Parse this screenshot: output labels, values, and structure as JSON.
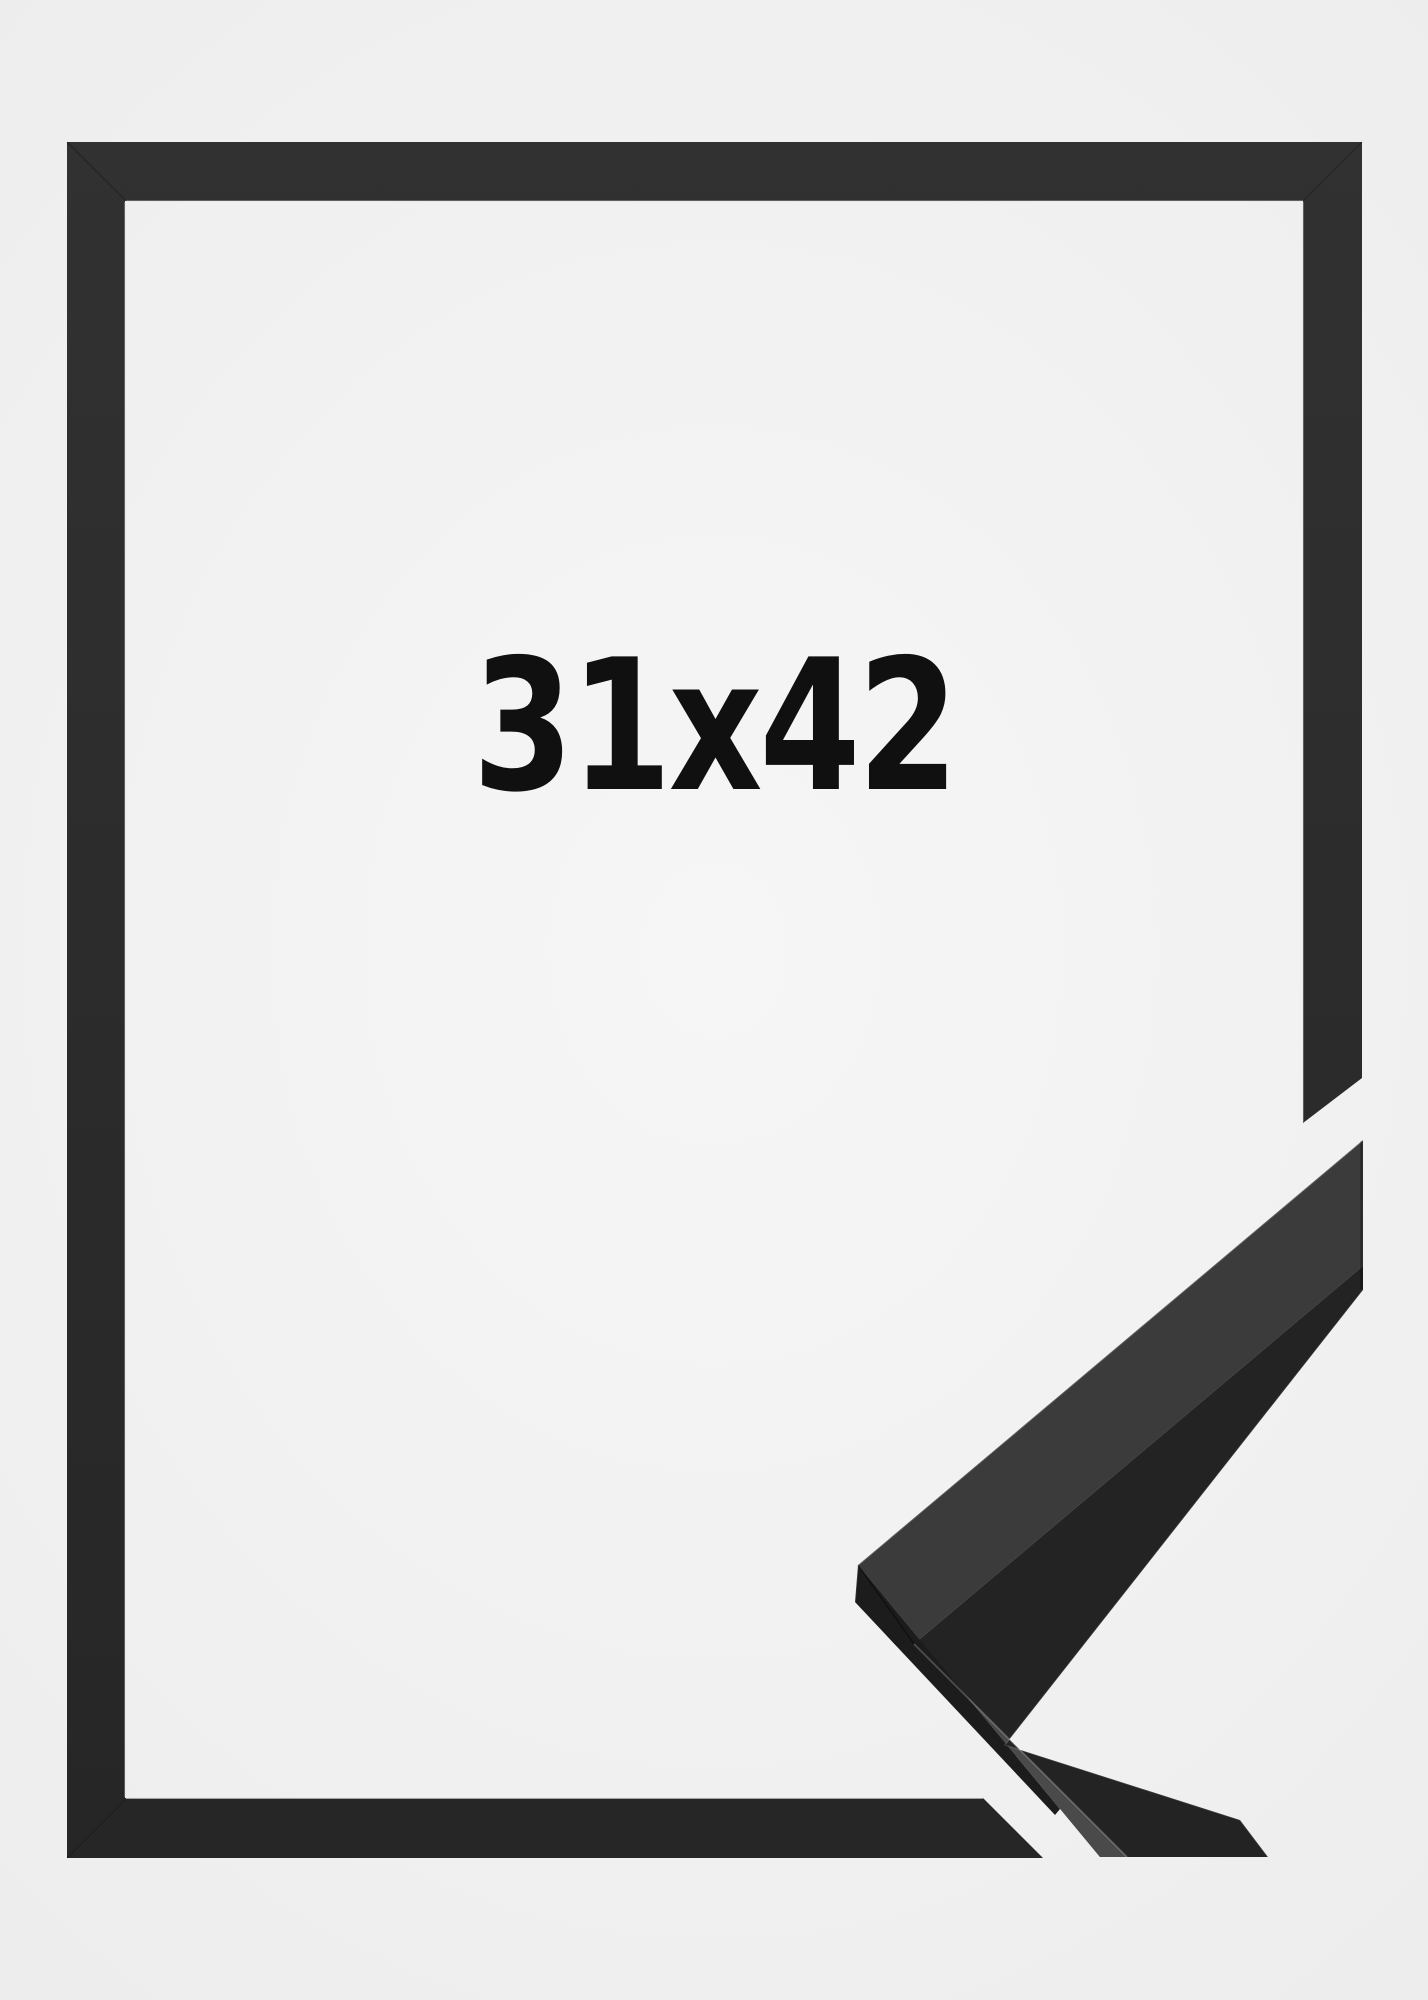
{
  "page": {
    "description": "Product photo of a black picture frame with a corner profile sample"
  },
  "product": {
    "size_label": "31x42"
  },
  "colors": {
    "background": "#f0f0f0",
    "background_center": "#f6f6f6",
    "background_edge": "#ededed",
    "frame_top": "#313131",
    "frame_bottom": "#262626",
    "sample_top": "#3b3b3b",
    "sample_sheen": "#4a4a4a",
    "sample_side": "#232323",
    "sample_bottom": "#1c1c1c",
    "label_text": "#101010"
  }
}
